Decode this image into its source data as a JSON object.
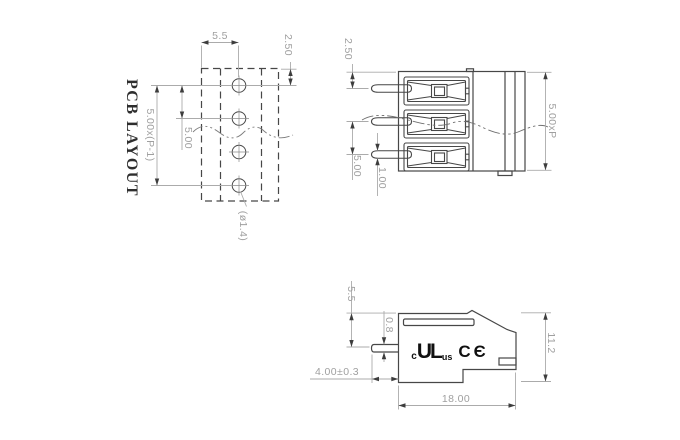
{
  "drawing": {
    "pcb_layout_view": {
      "title": "PCB LAYOUT",
      "dimensions": {
        "pad_span": "5.5",
        "edge_offset": "2.50",
        "total_pitch": "5.00x(P-1)",
        "pitch": "5.00",
        "hole_diameter": "(ø1.4)"
      }
    },
    "front_view": {
      "dimensions": {
        "edge_offset": "2.50",
        "pitch": "5.00",
        "pin_width": "1.00",
        "total_width": "5.00xP"
      }
    },
    "side_view": {
      "dimensions": {
        "pin_offset": "5.5",
        "pin_thickness": "0.8",
        "pin_length": "4.00±0.3",
        "body_height": "11.2",
        "body_depth": "18.00"
      },
      "certification_marks": {
        "ul_c": "c",
        "ul": "UL",
        "ul_us": "us",
        "ce": "CЄ"
      }
    }
  },
  "colors": {
    "object_line": "#474747",
    "dimension_line": "#ababab",
    "dimension_text": "#9f9f9f",
    "arrow": "#3d3d3d",
    "title_text": "#2e2e2e",
    "mark_text": "#101010",
    "background": "#ffffff"
  }
}
